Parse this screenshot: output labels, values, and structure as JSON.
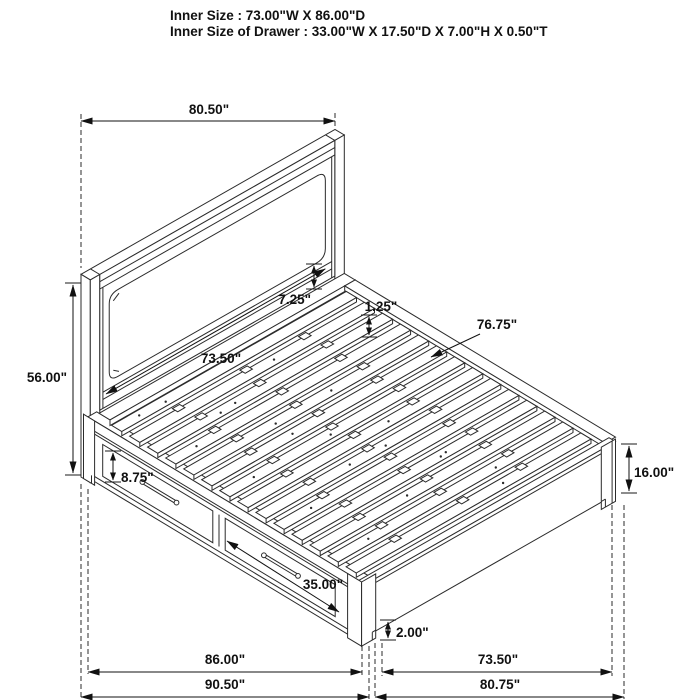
{
  "header": {
    "line1": "Inner Size : 73.00\"W X 86.00\"D",
    "line2": "Inner Size of Drawer : 33.00\"W X 17.50\"D X 7.00\"H X 0.50\"T"
  },
  "diagram": {
    "type": "isometric-storage-bed-dimension-drawing",
    "dimensions": {
      "headboard_width": "80.50\"",
      "headboard_height": "56.00\"",
      "headboard_panel_width": "73.50\"",
      "headboard_rail_height": "7.25\"",
      "slat_thickness": "1.25\"",
      "slat_length": "76.75\"",
      "drawer_front_height": "8.75\"",
      "leg_height": "16.00\"",
      "drawer_front_width": "35.00\"",
      "foot_clearance": "2.00\"",
      "side_rail_length": "86.00\"",
      "overall_depth": "90.50\"",
      "foot_inner_width": "73.50\"",
      "overall_width": "80.75\""
    },
    "colors": {
      "line": "#2b2b2b",
      "dimension": "#111111",
      "background": "#ffffff"
    }
  }
}
